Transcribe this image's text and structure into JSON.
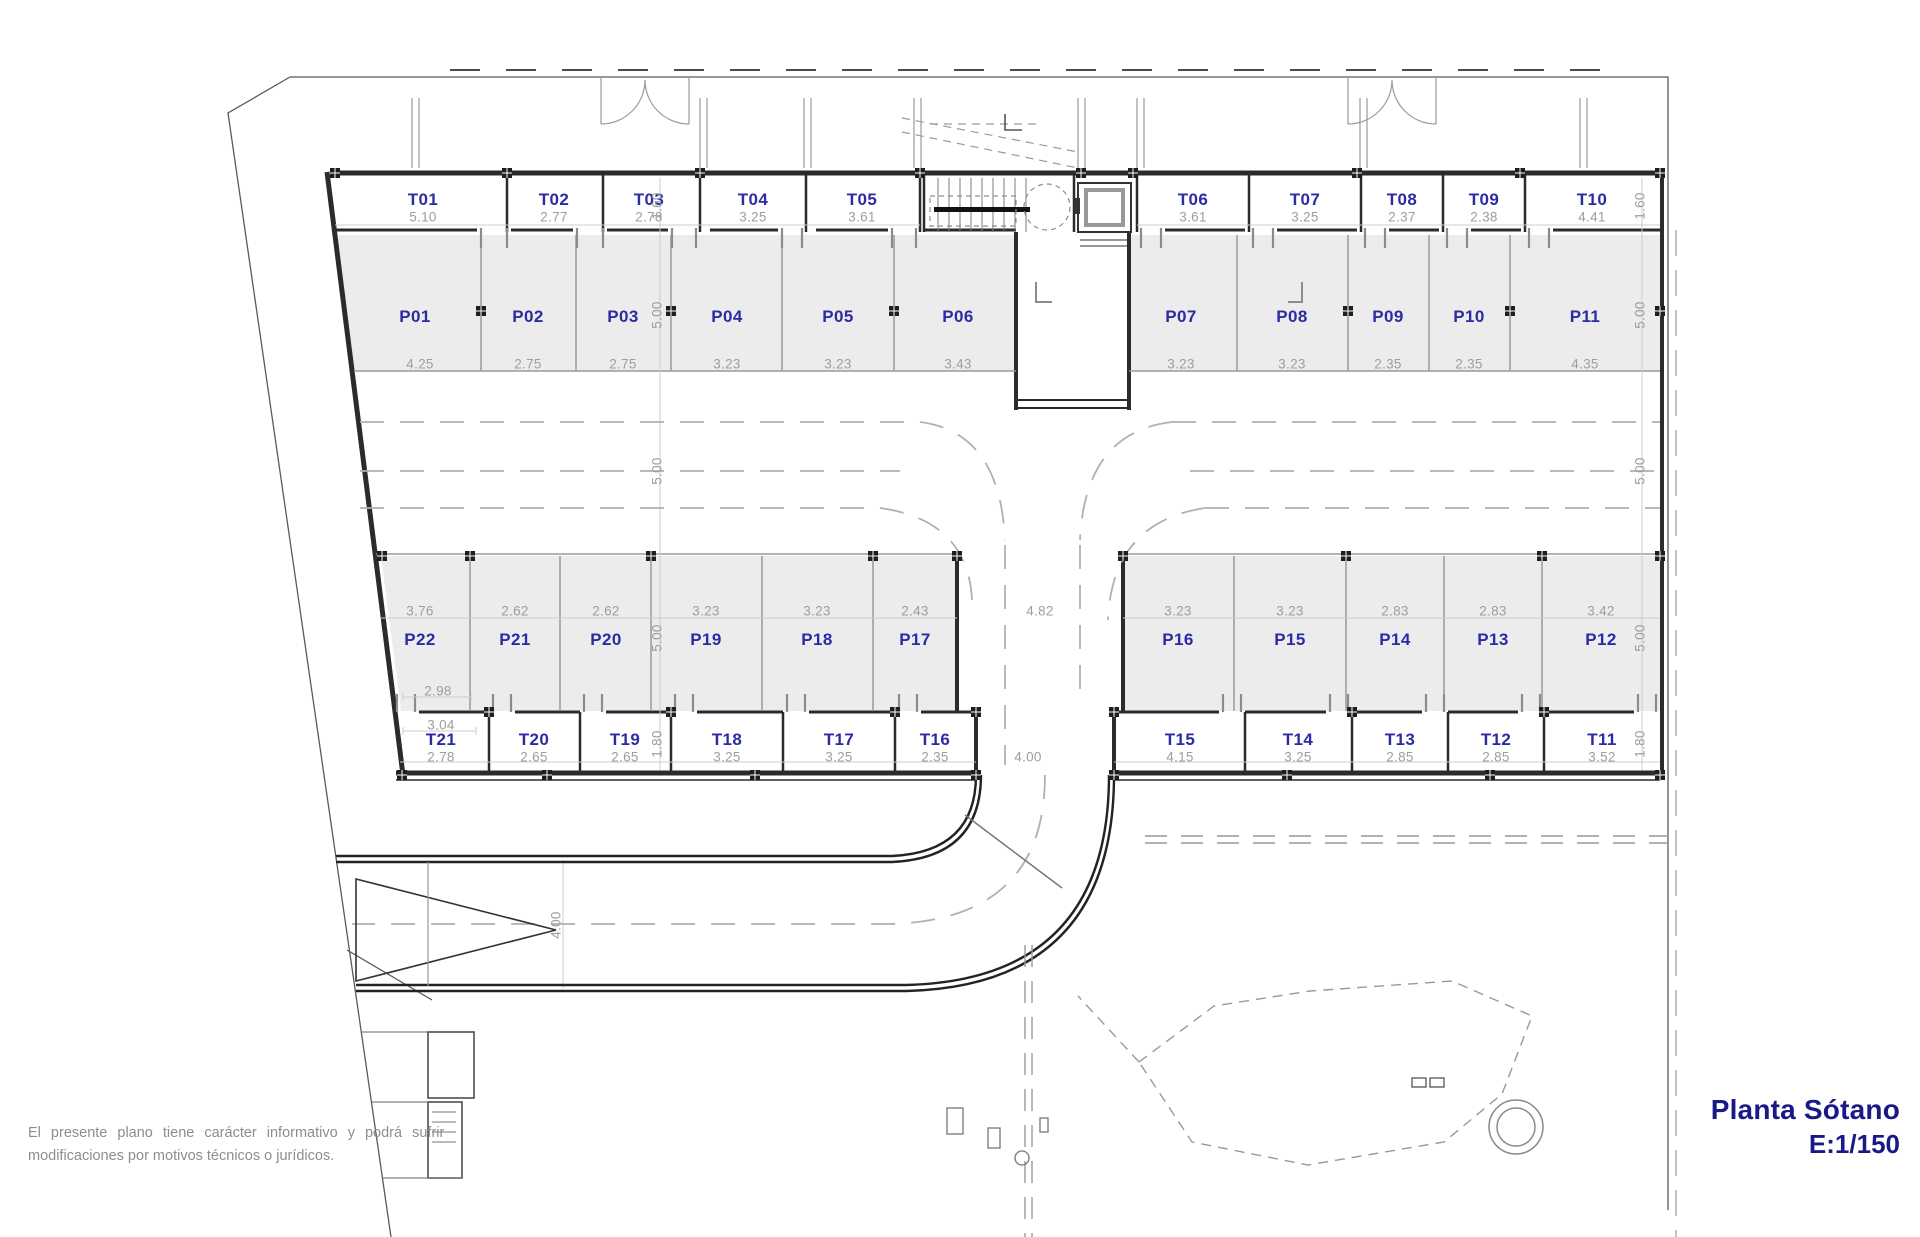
{
  "title": {
    "name": "Planta Sótano",
    "scale": "E:1/150"
  },
  "disclaimer": {
    "line1": "El presente plano tiene carácter informativo y podrá sufrir",
    "line2": "modificaciones por motivos técnicos o jurídicos."
  },
  "colors": {
    "label_blue": "#2b2ba4",
    "dim_gray": "#9e9e9e",
    "title_navy": "#1a1a87",
    "wall": "#2b2b2b",
    "stall_fill": "#ececec"
  },
  "top_storage": [
    {
      "id": "T01",
      "dim": "5.10"
    },
    {
      "id": "T02",
      "dim": "2.77"
    },
    {
      "id": "T03",
      "dim": "2.78"
    },
    {
      "id": "T04",
      "dim": "3.25"
    },
    {
      "id": "T05",
      "dim": "3.61"
    },
    {
      "id": "T06",
      "dim": "3.61"
    },
    {
      "id": "T07",
      "dim": "3.25"
    },
    {
      "id": "T08",
      "dim": "2.37"
    },
    {
      "id": "T09",
      "dim": "2.38"
    },
    {
      "id": "T10",
      "dim": "4.41"
    }
  ],
  "top_parking": [
    {
      "id": "P01",
      "dim": "4.25"
    },
    {
      "id": "P02",
      "dim": "2.75"
    },
    {
      "id": "P03",
      "dim": "2.75"
    },
    {
      "id": "P04",
      "dim": "3.23"
    },
    {
      "id": "P05",
      "dim": "3.23"
    },
    {
      "id": "P06",
      "dim": "3.43"
    },
    {
      "id": "P07",
      "dim": "3.23"
    },
    {
      "id": "P08",
      "dim": "3.23"
    },
    {
      "id": "P09",
      "dim": "2.35"
    },
    {
      "id": "P10",
      "dim": "2.35"
    },
    {
      "id": "P11",
      "dim": "4.35"
    }
  ],
  "mid_parking": [
    {
      "id": "P22",
      "dim": "3.76"
    },
    {
      "id": "P21",
      "dim": "2.62"
    },
    {
      "id": "P20",
      "dim": "2.62"
    },
    {
      "id": "P19",
      "dim": "3.23"
    },
    {
      "id": "P18",
      "dim": "3.23"
    },
    {
      "id": "P17",
      "dim": "2.43"
    },
    {
      "id": "P16",
      "dim": "3.23"
    },
    {
      "id": "P15",
      "dim": "3.23"
    },
    {
      "id": "P14",
      "dim": "2.83"
    },
    {
      "id": "P13",
      "dim": "2.83"
    },
    {
      "id": "P12",
      "dim": "3.42"
    }
  ],
  "bottom_storage": [
    {
      "id": "T21",
      "dim": "2.78"
    },
    {
      "id": "T20",
      "dim": "2.65"
    },
    {
      "id": "T19",
      "dim": "2.65"
    },
    {
      "id": "T18",
      "dim": "3.25"
    },
    {
      "id": "T17",
      "dim": "3.25"
    },
    {
      "id": "T16",
      "dim": "2.35"
    },
    {
      "id": "T15",
      "dim": "4.15"
    },
    {
      "id": "T14",
      "dim": "3.25"
    },
    {
      "id": "T13",
      "dim": "2.85"
    },
    {
      "id": "T12",
      "dim": "2.85"
    },
    {
      "id": "T11",
      "dim": "3.52"
    }
  ],
  "dims": {
    "storage_top_h": "1.60",
    "parking_depth": "5.00",
    "storage_bottom_h": "1.80",
    "center_ramp": "4.82",
    "bottom_road": "4.00",
    "entry_corridor": "4.00",
    "p22_front": "2.98",
    "p22_back": "3.04"
  }
}
